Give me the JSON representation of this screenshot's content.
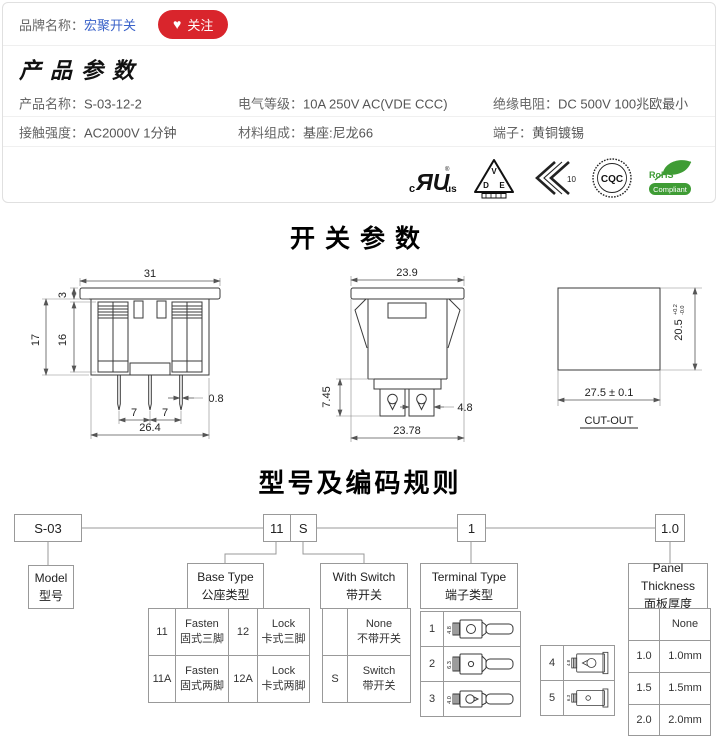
{
  "colors": {
    "accent_red": "#d9252c",
    "link_blue": "#3a62c9",
    "rohs_green": "#3f9c35"
  },
  "brand_bar": {
    "label": "品牌名称：",
    "brand": "宏聚开关",
    "heart": "♥",
    "follow": "关注"
  },
  "product_params": {
    "title": "产品参数",
    "rows": [
      [
        {
          "label": "产品名称：",
          "value": "S-03-12-2"
        },
        {
          "label": "电气等级：",
          "value": "10A 250V AC(VDE CCC)"
        },
        {
          "label": "绝缘电阻：",
          "value": "DC 500V 100兆欧最小"
        }
      ],
      [
        {
          "label": "接触强度：",
          "value": "AC2000V 1分钟"
        },
        {
          "label": "材料组成：",
          "value": "基座:尼龙66"
        },
        {
          "label": "端子：",
          "value": "黄铜镀锡"
        }
      ]
    ],
    "certs": {
      "ul": {
        "c": "c",
        "mark": "ЯU",
        "us": "us",
        "reg": "®"
      },
      "vde": {
        "v": "V",
        "d": "D",
        "e": "E"
      },
      "enec": {
        "num": "10"
      },
      "cqc": {
        "label": "CQC"
      },
      "rohs": {
        "top": "RoHS",
        "bottom": "Compliant"
      }
    }
  },
  "switch_section": {
    "title": "开关参数",
    "front_view": {
      "w_top": "31",
      "flange": "3",
      "h_total": "17",
      "h_body": "16",
      "pitch_l": "7",
      "pitch_r": "7",
      "pin_w": "0.8",
      "w_bottom": "26.4"
    },
    "side_view": {
      "w_top": "23.9",
      "term_h": "7.45",
      "term_w": "4.8",
      "w_bottom": "23.78"
    },
    "cutout": {
      "h": "20.5",
      "tol_p": "+0.2",
      "tol_m": "-0.0",
      "w": "27.5 ± 0.1",
      "label": "CUT-OUT"
    }
  },
  "coding": {
    "title": "型号及编码规则",
    "code_boxes": [
      "S-03",
      "11",
      "S",
      "1",
      "1.0"
    ],
    "model": {
      "en": "Model",
      "cn": "型号"
    },
    "base_type": {
      "en": "Base Type",
      "cn": "公座类型",
      "rows": [
        [
          {
            "code": "11",
            "en": "Fasten",
            "cn": "固式三脚"
          },
          {
            "code": "12",
            "en": "Lock",
            "cn": "卡式三脚"
          }
        ],
        [
          {
            "code": "11A",
            "en": "Fasten",
            "cn": "固式两脚"
          },
          {
            "code": "12A",
            "en": "Lock",
            "cn": "卡式两脚"
          }
        ]
      ]
    },
    "with_switch": {
      "en": "With Switch",
      "cn": "带开关",
      "rows": [
        {
          "code": "",
          "en": "None",
          "cn": "不带开关"
        },
        {
          "code": "S",
          "en": "Switch",
          "cn": "带开关"
        }
      ]
    },
    "terminal_type": {
      "en": "Terminal Type",
      "cn": "端子类型",
      "left_rows": [
        "1",
        "2",
        "3"
      ],
      "right_rows": [
        "4",
        "5"
      ],
      "dims": [
        "4.8",
        "6.3",
        "4.0",
        "4.8",
        "6.3"
      ]
    },
    "panel_thickness": {
      "en": "Panel Thickness",
      "cn": "面板厚度",
      "rows": [
        {
          "code": "",
          "value": "None"
        },
        {
          "code": "1.0",
          "value": "1.0mm"
        },
        {
          "code": "1.5",
          "value": "1.5mm"
        },
        {
          "code": "2.0",
          "value": "2.0mm"
        }
      ]
    }
  }
}
